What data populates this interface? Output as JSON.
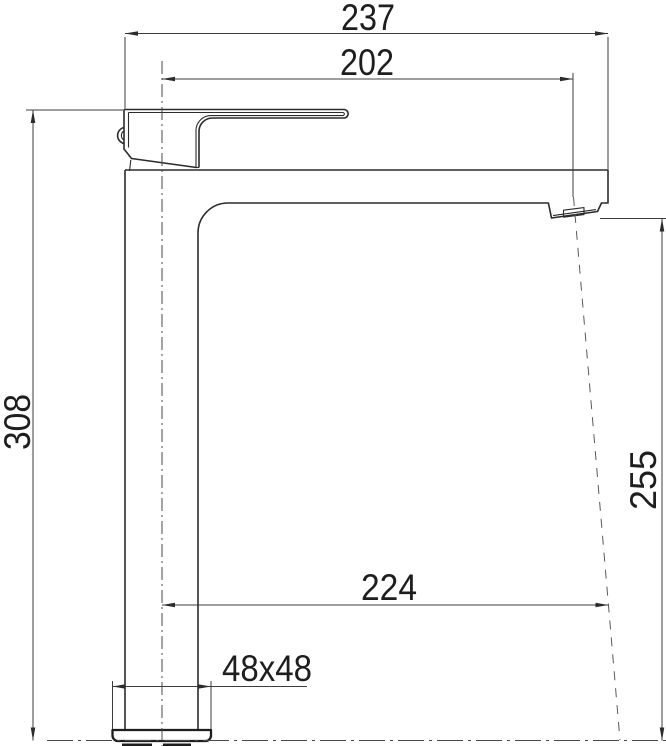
{
  "drawing": {
    "name": "tall-single-lever-basin-mixer-dimension-drawing",
    "background_color": "#ffffff",
    "line_color": "#2b2b2b",
    "dimension_line_color": "#3c3c3c",
    "text_color": "#1e1e1e",
    "dimensions": {
      "overall_length_mm": "237",
      "spout_reach_to_outlet_mm": "202",
      "overall_height_mm": "308",
      "outlet_height_mm": "255",
      "stream_reach_mm": "224",
      "base_section_mm": "48x48"
    }
  }
}
